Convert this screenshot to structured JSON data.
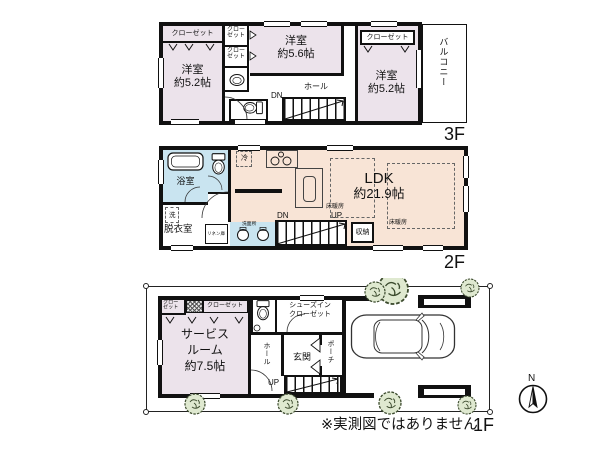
{
  "meta": {
    "disclaimer": "※実測図ではありません",
    "north": "N"
  },
  "colors": {
    "room_pink": "#ece3eb",
    "ldk_peach": "#f8e4d6",
    "wet_blue": "#c9e4f0",
    "wall": "#111111",
    "bush_green": "#dfe9d0"
  },
  "f3": {
    "floor_label": "3F",
    "rooms": [
      {
        "name": "洋室",
        "size": "約5.2帖"
      },
      {
        "name": "洋室",
        "size": "約5.6帖"
      },
      {
        "name": "洋室",
        "size": "約5.2帖"
      }
    ],
    "closet_left": "クローゼット",
    "closet_right": "クローゼット",
    "closet_small": "クロー\nゼット",
    "hall": "ホール",
    "dn": "DN",
    "balcony": "バルコニー"
  },
  "f2": {
    "floor_label": "2F",
    "bath": "浴室",
    "laundry": "洗",
    "dressing": "脱衣室",
    "linen": "リネン庫",
    "lavatory": "洗面所",
    "fridge": "冷",
    "dn": "DN",
    "up": "UP",
    "floor_heating": "床暖房",
    "ldk_name": "LDK",
    "ldk_size": "約21.9帖",
    "storage": "収納"
  },
  "f1": {
    "floor_label": "1F",
    "closet_small": "クロー\nゼット",
    "closet": "クローゼット",
    "service_line1": "サービス",
    "service_line2": "ルーム",
    "service_size": "約7.5帖",
    "shoes_line1": "シューズイン",
    "shoes_line2": "クローゼット",
    "entrance": "玄関",
    "porch": "ポーチ",
    "hall": "ホール",
    "up": "UP"
  }
}
